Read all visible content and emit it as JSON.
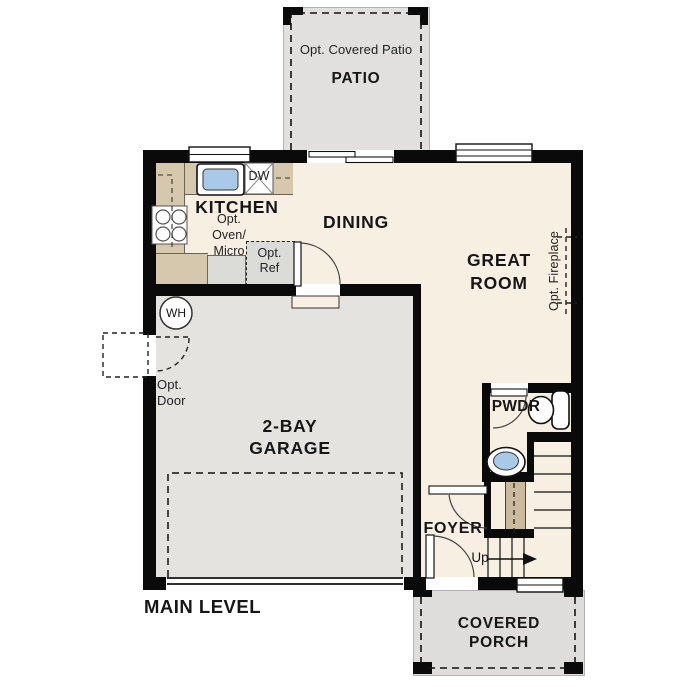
{
  "title": "MAIN LEVEL",
  "rooms": {
    "patio": {
      "opt": "Opt. Covered Patio",
      "name": "PATIO"
    },
    "kitchen": {
      "name": "KITCHEN",
      "dw": "DW",
      "opt_oven": [
        "Opt.",
        "Oven/",
        "Micro"
      ],
      "opt_ref": [
        "Opt.",
        "Ref"
      ]
    },
    "dining": {
      "name": "DINING"
    },
    "great_room": {
      "name_lines": [
        "GREAT",
        "ROOM"
      ],
      "opt_fireplace": "Opt. Fireplace"
    },
    "garage": {
      "name_lines": [
        "2-BAY",
        "GARAGE"
      ],
      "wh": "WH",
      "opt_door": [
        "Opt.",
        "Door"
      ]
    },
    "pwdr": {
      "name": "PWDR"
    },
    "foyer": {
      "name": "FOYER",
      "up": "Up"
    },
    "porch": {
      "name_lines": [
        "COVERED",
        "PORCH"
      ]
    }
  },
  "colors": {
    "wall": "#0a0a0a",
    "interior": "#f7efe2",
    "garage": "#e4e3df",
    "patio": "#e1e0de",
    "porch": "#dedddb",
    "counter": "#d5c8ac",
    "stair_strip": "#cabb9e",
    "sink_blue": "#a9c9e9",
    "cabinet_gray": "#dbdbd8"
  }
}
